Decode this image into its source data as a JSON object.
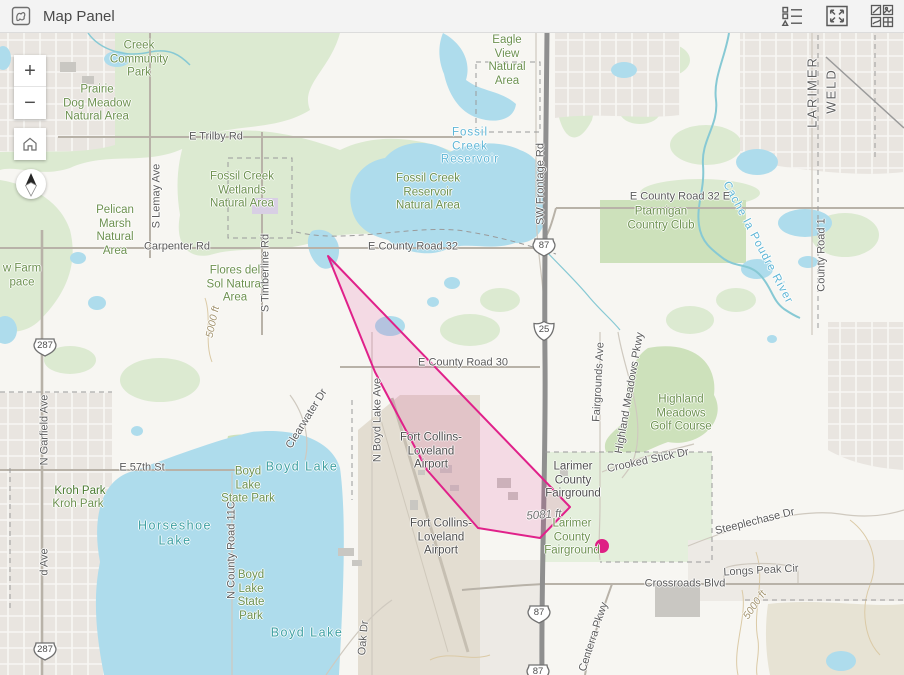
{
  "header": {
    "title": "Map Panel",
    "actions": [
      {
        "name": "legend-icon",
        "label": "Legend"
      },
      {
        "name": "expand-icon",
        "label": "Expand"
      },
      {
        "name": "basemap-gallery-icon",
        "label": "Basemap Gallery"
      }
    ]
  },
  "controls": {
    "zoom_in": "+",
    "zoom_out": "−"
  },
  "colors": {
    "highlight_stroke": "#e0218a",
    "highlight_fill": "rgba(224,33,138,0.13)",
    "dot_color": "#de1f84",
    "water": "#aedcec",
    "vegetation": "#dcead1"
  },
  "map": {
    "highlight": {
      "polygon_points": "328,256 570,507 540,538 478,528 427,470 375,372",
      "dot": {
        "x": 602,
        "y": 546,
        "r": 7
      }
    },
    "shields": [
      {
        "type": "us",
        "label": "287",
        "x": 45,
        "y": 347
      },
      {
        "type": "us",
        "label": "287",
        "x": 45,
        "y": 651
      },
      {
        "type": "us",
        "label": "87",
        "x": 544,
        "y": 247
      },
      {
        "type": "int",
        "label": "25",
        "x": 544,
        "y": 331
      },
      {
        "type": "us",
        "label": "87",
        "x": 539,
        "y": 614
      },
      {
        "type": "us",
        "label": "87",
        "x": 538,
        "y": 673
      }
    ],
    "labels": [
      {
        "text": "Creek\nCommunity\nPark",
        "x": 139,
        "y": 60,
        "cls": "park"
      },
      {
        "text": "Prairie\nDog Meadow\nNatural Area",
        "x": 97,
        "y": 104,
        "cls": "park"
      },
      {
        "text": "Eagle\nView\nNatural\nArea",
        "x": 507,
        "y": 61,
        "cls": "park"
      },
      {
        "text": "Fossil Creek\nWetlands\nNatural Area",
        "x": 242,
        "y": 191,
        "cls": "park"
      },
      {
        "text": "Fossil Creek\nReservoir\nNatural Area",
        "x": 428,
        "y": 193,
        "cls": "park"
      },
      {
        "text": "Pelican\nMarsh\nNatural\nArea",
        "x": 115,
        "y": 231,
        "cls": "park"
      },
      {
        "text": "Flores del\nSol Natural\nArea",
        "x": 235,
        "y": 285,
        "cls": "park"
      },
      {
        "text": "Ptarmigan\nCountry Club",
        "x": 661,
        "y": 219,
        "cls": "park"
      },
      {
        "text": "Highland\nMeadows\nGolf Course",
        "x": 681,
        "y": 414,
        "cls": "park"
      },
      {
        "text": "Boyd\nLake\nState Park",
        "x": 248,
        "y": 486,
        "cls": "park"
      },
      {
        "text": "Kroh Park",
        "x": 80,
        "y": 492,
        "cls": "park-dark"
      },
      {
        "text": "Kroh Park",
        "x": 78,
        "y": 505,
        "cls": "park"
      },
      {
        "text": "Boyd\nLake\nState\nPark",
        "x": 251,
        "y": 596,
        "cls": "park"
      },
      {
        "text": "w Farm\npace",
        "x": 22,
        "y": 276,
        "cls": "park"
      },
      {
        "text": "Larimer\nCounty\nFairground",
        "x": 572,
        "y": 538,
        "cls": "park"
      },
      {
        "text": "Fossil\nCreek\nReservoir",
        "x": 470,
        "y": 147,
        "cls": "water"
      },
      {
        "text": "Cache la Poudre River",
        "x": 757,
        "y": 243,
        "cls": "water",
        "rot": 62
      },
      {
        "text": "Boyd Lake",
        "x": 302,
        "y": 467,
        "cls": "lake"
      },
      {
        "text": "Horseshoe\nLake",
        "x": 175,
        "y": 533,
        "cls": "lake"
      },
      {
        "text": "Boyd Lake",
        "x": 307,
        "y": 633,
        "cls": "lake"
      },
      {
        "text": "E Trilby Rd",
        "x": 216,
        "y": 137,
        "cls": "road"
      },
      {
        "text": "Carpenter Rd",
        "x": 177,
        "y": 247,
        "cls": "road"
      },
      {
        "text": "E County Road 32",
        "x": 413,
        "y": 247,
        "cls": "road"
      },
      {
        "text": "E County Road 32 E",
        "x": 680,
        "y": 197,
        "cls": "road"
      },
      {
        "text": "E County Road 30",
        "x": 463,
        "y": 363,
        "cls": "road"
      },
      {
        "text": "E 57th St",
        "x": 142,
        "y": 468,
        "cls": "road"
      },
      {
        "text": "Crossroads Blvd",
        "x": 685,
        "y": 584,
        "cls": "road"
      },
      {
        "text": "Longs Peak Cir",
        "x": 761,
        "y": 571,
        "cls": "road",
        "rot": -3
      },
      {
        "text": "Steeplechase Dr",
        "x": 755,
        "y": 522,
        "cls": "road",
        "rot": -14
      },
      {
        "text": "Crooked Stick Dr",
        "x": 648,
        "y": 461,
        "cls": "road",
        "rot": -12
      },
      {
        "text": "S Lemay Ave",
        "x": 157,
        "y": 196,
        "cls": "road",
        "rot": -90
      },
      {
        "text": "S Timberline Rd",
        "x": 266,
        "y": 273,
        "cls": "road",
        "rot": -90
      },
      {
        "text": "SW Frontage Rd",
        "x": 541,
        "y": 184,
        "cls": "road",
        "rot": -90
      },
      {
        "text": "N Boyd Lake Ave",
        "x": 378,
        "y": 420,
        "cls": "road",
        "rot": -90
      },
      {
        "text": "Fairgrounds Ave",
        "x": 599,
        "y": 382,
        "cls": "road",
        "rot": -87
      },
      {
        "text": "Highland Meadows Pkwy",
        "x": 630,
        "y": 393,
        "cls": "road",
        "rot": -80
      },
      {
        "text": "County Road 1",
        "x": 822,
        "y": 255,
        "cls": "road",
        "rot": -90
      },
      {
        "text": "N Garfield Ave",
        "x": 45,
        "y": 430,
        "cls": "road",
        "rot": -90
      },
      {
        "text": "d Ave",
        "x": 45,
        "y": 562,
        "cls": "road",
        "rot": -90
      },
      {
        "text": "Centerra Pkwy",
        "x": 594,
        "y": 637,
        "cls": "road",
        "rot": -72
      },
      {
        "text": "N County Road 11C",
        "x": 232,
        "y": 550,
        "cls": "road",
        "rot": -90
      },
      {
        "text": "Oak Dr",
        "x": 364,
        "y": 638,
        "cls": "road",
        "rot": -85
      },
      {
        "text": "Clearwater Dr",
        "x": 307,
        "y": 419,
        "cls": "road",
        "rot": -58
      },
      {
        "text": "LARIMER",
        "x": 812,
        "y": 92,
        "cls": "county",
        "rot": -90
      },
      {
        "text": "WELD",
        "x": 831,
        "y": 91,
        "cls": "county",
        "rot": -90
      },
      {
        "text": "5081 ft",
        "x": 544,
        "y": 516,
        "cls": "elev",
        "rot": -4
      },
      {
        "text": "5000 ft",
        "x": 213,
        "y": 322,
        "cls": "contour",
        "rot": -78
      },
      {
        "text": "5000 ft",
        "x": 755,
        "y": 605,
        "cls": "contour",
        "rot": -55
      },
      {
        "text": "Larimer\nCounty\nFairground",
        "x": 573,
        "y": 481,
        "cls": "place"
      },
      {
        "text": "Fort Collins-\nLoveland\nAirport",
        "x": 431,
        "y": 452,
        "cls": "place"
      },
      {
        "text": "Fort Collins-\nLoveland\nAirport",
        "x": 441,
        "y": 538,
        "cls": "place"
      }
    ]
  }
}
